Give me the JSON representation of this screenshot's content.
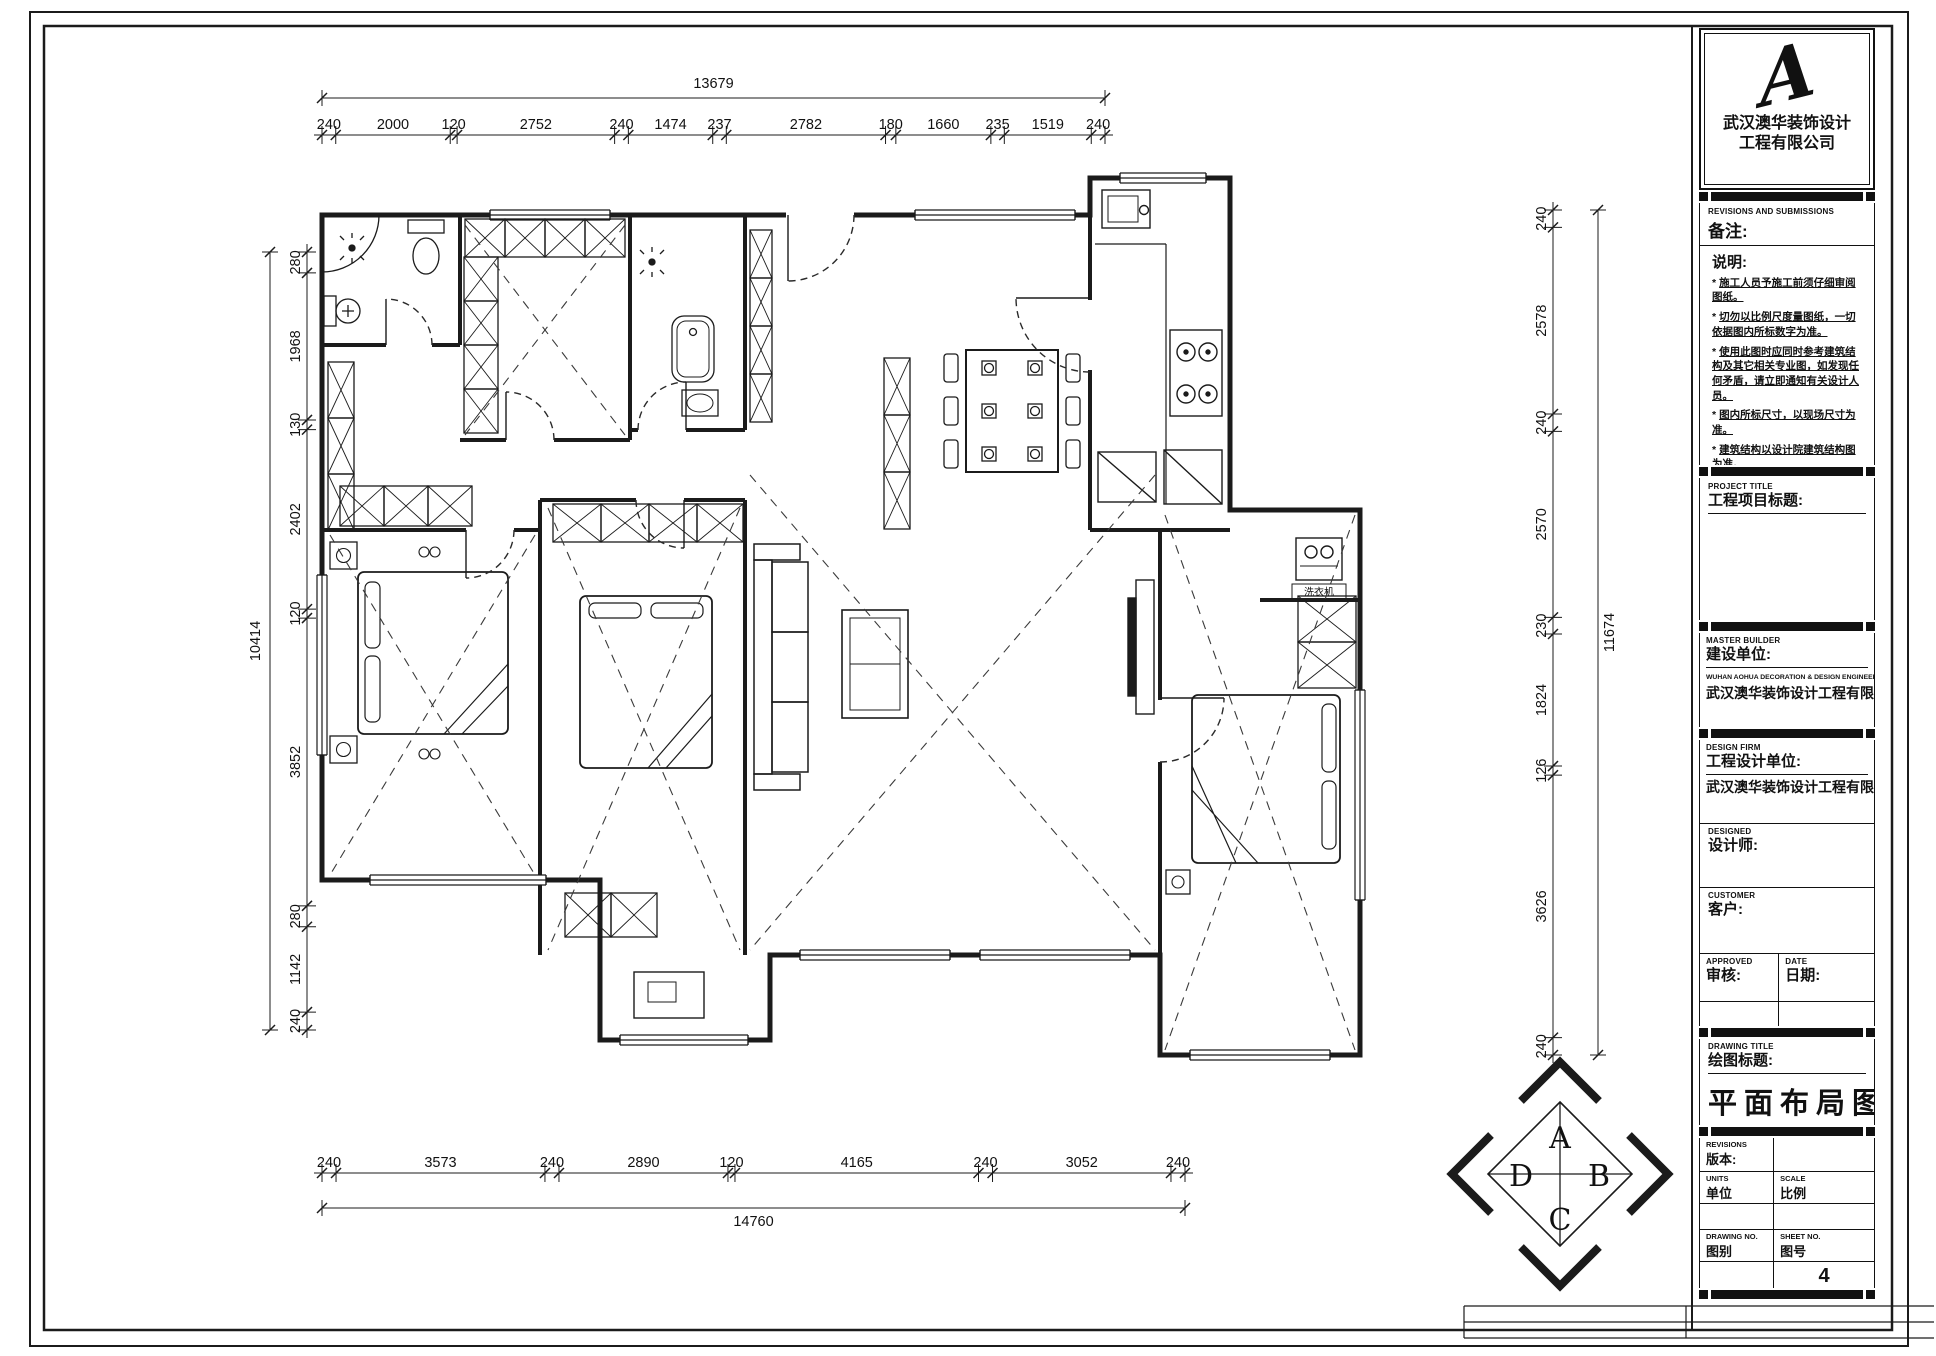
{
  "sheet": {
    "compass": {
      "top": "A",
      "right": "B",
      "bottom": "C",
      "left": "D"
    }
  },
  "dimensions": {
    "top": {
      "total": "13679",
      "segments": [
        "240",
        "2000",
        "120",
        "2752",
        "240",
        "1474",
        "237",
        "2782",
        "180",
        "1660",
        "235",
        "1519",
        "240"
      ]
    },
    "bottom": {
      "total": "14760",
      "segments": [
        "240",
        "3573",
        "240",
        "2890",
        "120",
        "4165",
        "240",
        "3052",
        "240"
      ]
    },
    "left": {
      "total": "10414",
      "segments": [
        "280",
        "1968",
        "130",
        "2402",
        "120",
        "3852",
        "280",
        "1142",
        "240"
      ]
    },
    "right": {
      "total": "11674",
      "segments": [
        "240",
        "2578",
        "240",
        "2570",
        "230",
        "1824",
        "126",
        "3626",
        "240"
      ]
    }
  },
  "plan": {
    "labels": {
      "washing_machine": "洗衣机"
    }
  },
  "title_block": {
    "logo": {
      "monogram": "A",
      "line1": "武汉澳华装饰设计",
      "line2": "工程有限公司"
    },
    "revisions_header": {
      "en": "REVISIONS AND SUBMISSIONS",
      "zh": "备注:"
    },
    "notes": {
      "heading": "说明:",
      "bullet": "*",
      "items": [
        "施工人员予施工前须仔细审阅图纸。",
        "切勿以比例尺度量图纸，一切依据图内所标数字为准。",
        "使用此图时应同时参考建筑结构及其它相关专业图，如发现任何矛盾，请立即通知有关设计人员。",
        "图内所标尺寸，以现场尺寸为准。",
        "建筑结构以设计院建筑结构图为准。",
        "未加盖本公司设计图章不准在施工中使用。"
      ]
    },
    "project": {
      "en": "PROJECT TITLE",
      "zh": "工程项目标题:"
    },
    "builder": {
      "en": "MASTER BUILDER",
      "zh": "建设单位:",
      "company_en": "WUHAN AOHUA DECORATION & DESIGN ENGINEERING  CO.LTD",
      "company_zh": "武汉澳华装饰设计工程有限公司"
    },
    "design_firm": {
      "en": "DESIGN FIRM",
      "zh": "工程设计单位:",
      "company": "武汉澳华装饰设计工程有限公司"
    },
    "designer": {
      "en": "DESIGNED",
      "zh": "设计师:"
    },
    "customer": {
      "en": "CUSTOMER",
      "zh": "客户:"
    },
    "approved": {
      "en": "APPROVED",
      "zh": "审核:"
    },
    "date": {
      "en": "DATE",
      "zh": "日期:"
    },
    "drawing_title": {
      "en": "DRAWING TITLE",
      "zh": "绘图标题:",
      "value": "平面布局图"
    },
    "revision": {
      "en": "REVISIONS",
      "zh": "版本:"
    },
    "units": {
      "en": "UNITS",
      "zh": "单位"
    },
    "scale": {
      "en": "SCALE",
      "zh": "比例"
    },
    "drawing_no": {
      "en": "DRAWING NO.",
      "zh": "图别"
    },
    "sheet_no": {
      "en": "SHEET NO.",
      "zh": "图号",
      "value": "4"
    }
  }
}
